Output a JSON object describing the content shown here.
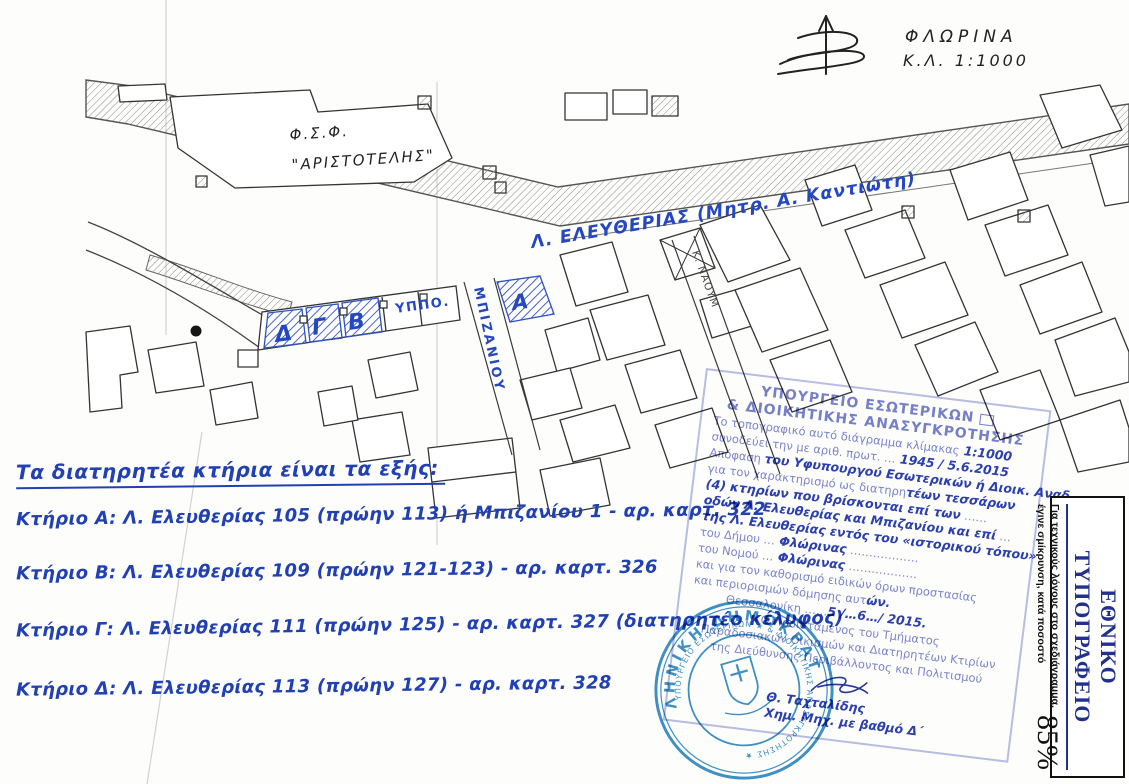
{
  "map": {
    "city_title": "ΦΛΩΡΙΝΑ",
    "scale_note": "Κ.Λ. 1:1000",
    "school_line1": "Φ.Σ.Φ.",
    "school_line2": "\"ΑΡΙΣΤΟΤΕΛΗΣ\"",
    "avenue_label": "Λ. ΕΛΕΥΘΕΡΙΑΣ (Μητρ. Α. Καντιώτη)",
    "side_street_label": "ΜΠΙΖΑΝΙΟΥ",
    "cross_street_label": "Κ. ΝΑΟΥΜ",
    "ministry_abbrev": "ΥΠΠΟ.",
    "building_letters": {
      "a": "Α",
      "b": "Β",
      "c": "Γ",
      "d": "Δ"
    },
    "ink_blue": "#2547c0"
  },
  "notes": {
    "heading": "Τα διατηρητέα κτήρια είναι τα εξής:",
    "items": [
      "Κτήριο Α: Λ. Ελευθερίας 105 (πρώην 113) ή Μπιζανίου 1 - αρ. καρτ. 322",
      "Κτήριο Β: Λ. Ελευθερίας 109 (πρώην 121-123) - αρ. καρτ. 326",
      "Κτήριο Γ: Λ. Ελευθερίας 111 (πρώην 125) - αρ. καρτ. 327 (διατηρητέο κέλυφος)",
      "Κτήριο Δ: Λ. Ελευθερίας 113 (πρώην 127) - αρ. καρτ. 328"
    ]
  },
  "rect_stamp": {
    "header_line1": "ΥΠΟΥΡΓΕΙΟ ΕΣΩΤΕΡΙΚΩΝ",
    "header_line2": "& ΔΙΟΙΚΗΤΙΚΗΣ ΑΝΑΣΥΓΚΡΟΤΗΣΗΣ",
    "lines": [
      {
        "pre": "Το τοπογραφικό αυτό διάγραμμα κλίμακας",
        "hw": " 1:1000",
        "post": ""
      },
      {
        "pre": "συνοδεύει την με αριθ. πρωτ. …",
        "hw": " 1945 / 5.6.2015",
        "post": ""
      },
      {
        "pre": "Απόφαση ",
        "hw": "του Υφυπουργού Εσωτερικών ή Διοικ. Αναδ.",
        "post": ""
      },
      {
        "pre": "για τον χαρακτηρισμό ως διατηρη",
        "hw": "τέων τεσσάρων",
        "post": ""
      },
      {
        "pre": "",
        "hw": "(4) κτηρίων που βρίσκονται επί των",
        "post": " ……"
      },
      {
        "pre": "",
        "hw": "οδών Λ. Ελευθερίας και Μπιζανίου και επί",
        "post": " …"
      },
      {
        "pre": "",
        "hw": "της Λ. Ελευθερίας εντός του «ιστορικού τόπου»",
        "post": ""
      },
      {
        "pre": "του Δήμου …",
        "hw": " Φλώρινας",
        "post": " ………………"
      },
      {
        "pre": "του Νομού …",
        "hw": " Φλώρινας",
        "post": " ………………"
      },
      {
        "pre": "και για τον καθορισμό ειδικών όρων προστασίας",
        "hw": "",
        "post": ""
      },
      {
        "pre": "και περιορισμών δόμησης αυτ",
        "hw": "ών.",
        "post": ""
      },
      {
        "pre": "Θεσσαλονίκη ……",
        "hw": "5 /…6…/ 2015.",
        "post": ""
      },
      {
        "pre": "Ο Προϊστάμενος του Τμήματος",
        "hw": "",
        "post": ""
      },
      {
        "pre": "Παραδοσιακών Οικισμών και Διατηρητέων Κτιρίων",
        "hw": "",
        "post": ""
      },
      {
        "pre": "της Διεύθυνσης Περιβάλλοντος και Πολιτισμού",
        "hw": "",
        "post": ""
      }
    ],
    "signature_name": "Θ. Ταχταλίδης",
    "signature_role": "Χημ. Μηχ. με βαθμό Δ΄",
    "print_color": "#7d87cf",
    "ink_color": "#2b3fb2"
  },
  "round_stamp": {
    "outer_text": "ΕΛΛΗΝΙΚΗ ΔΗΜΟΚΡΑΤΙΑ",
    "inner_text": "ΥΠΟΥΡΓΕΙΟ ΕΣΩΤΕΡΙΚΩΝ ★ & ΔΙΟΙΚΗΤΙΚΗΣ ΑΝΑΣΥΓΚΡΟΤΗΣΗΣ ★",
    "color": "#2d86c0"
  },
  "print_office": {
    "title": "ΕΘΝΙΚΟ ΤΥΠΟΓΡΑΦΕΙΟ",
    "note": "Για τεχνικούς λόγους στο σχεδιάγραμμα, έγινε σμίκρυνση, κατά ποσοστό",
    "percent": "85%",
    "title_color": "#22318f"
  }
}
